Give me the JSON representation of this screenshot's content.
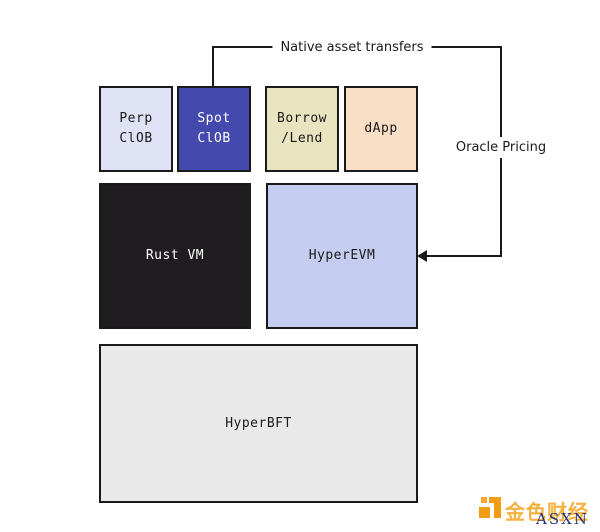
{
  "diagram": {
    "description": "Hyperliquid architecture diagram",
    "boxes": {
      "perp_clob": {
        "label": "Perp\nClOB",
        "bg": "#dfe1f4",
        "fg": "#1a1a1a"
      },
      "spot_clob": {
        "label": "Spot\nClOB",
        "bg": "#444aad",
        "fg": "#ffffff"
      },
      "borrow_lend": {
        "label": "Borrow\n/Lend",
        "bg": "#e8e4c0",
        "fg": "#1a1a1a"
      },
      "dapp": {
        "label": "dApp",
        "bg": "#f8dfc6",
        "fg": "#1a1a1a"
      },
      "rust_vm": {
        "label": "Rust VM",
        "bg": "#1f1d1f",
        "fg": "#ffffff"
      },
      "hyper_evm": {
        "label": "HyperEVM",
        "bg": "#c4cdef",
        "fg": "#1a1a1a"
      },
      "hyper_bft": {
        "label": "HyperBFT",
        "bg": "#e9e9e9",
        "fg": "#1a1a1a"
      }
    },
    "connectors": {
      "native_asset_transfers": {
        "label": "Native asset transfers"
      },
      "oracle_pricing": {
        "label": "Oracle Pricing"
      },
      "line_color": "#1a1a1a",
      "arrow_target": "HyperEVM"
    }
  },
  "watermark": {
    "brand_cn": "金色财经",
    "brand_en": "ASXN",
    "brand_cn_color": "#f4a41f",
    "brand_en_color": "#273272"
  }
}
